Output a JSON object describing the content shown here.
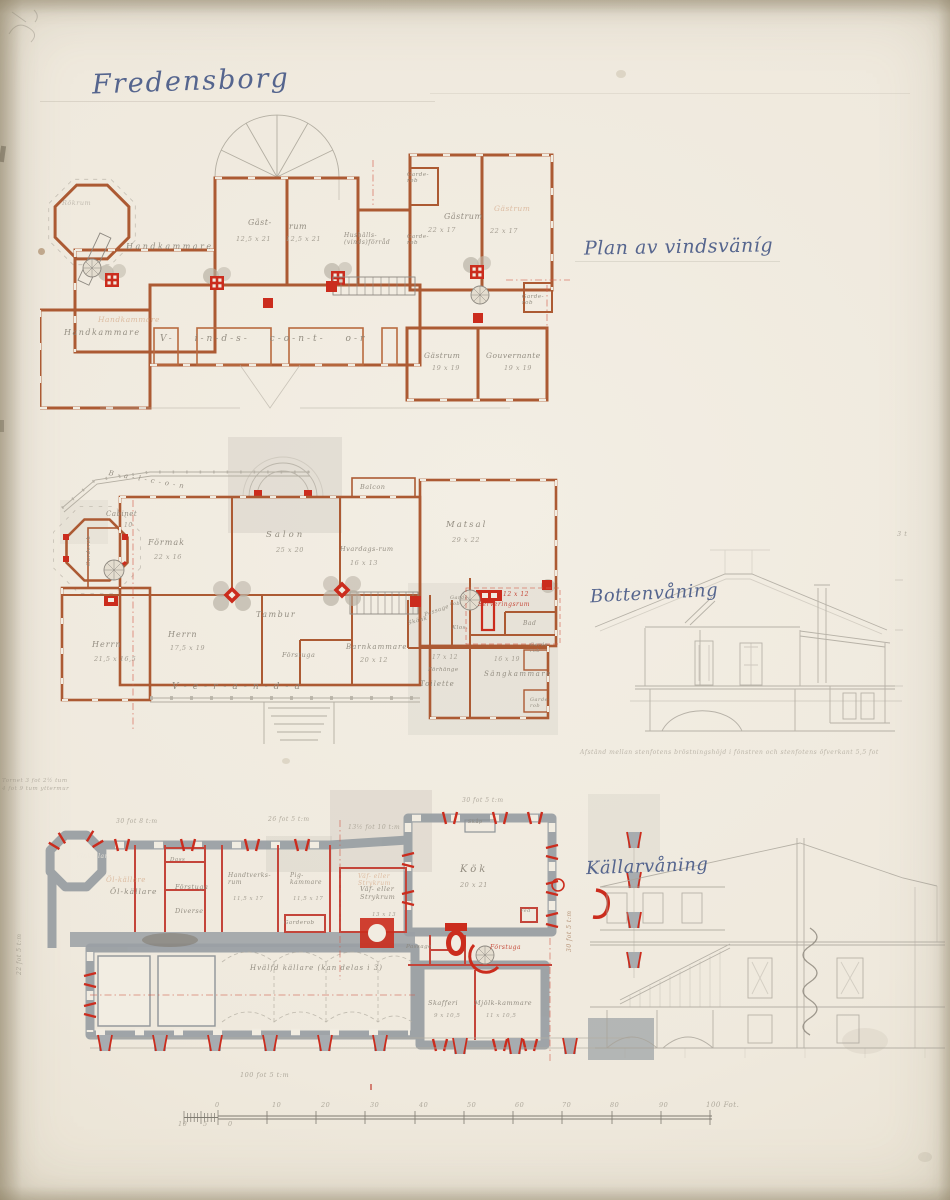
{
  "title": "Fredensborg",
  "floor_labels": {
    "attic": "Plan av vindsväníg",
    "ground": "Bottenvåning",
    "basement": "Källarvåning"
  },
  "notes": {
    "section_note": "Afstånd mellan stenfotens bröstningshöjd i fönstren och stenfotens öfverkant 5,5 fot",
    "margin_note": "Tornet 3 fot 2½ tum\n4 fot 9 tum yttermur",
    "roof_note": "3 t"
  },
  "attic": {
    "rooms": [
      {
        "label": "Rökrum"
      },
      {
        "label": "Handkammare"
      },
      {
        "label": "Gäst-",
        "dims": "12,5 x 21"
      },
      {
        "label": "rum",
        "dims": "12,5 x 21"
      },
      {
        "label": "Hushålls-\n(vinds)förråd"
      },
      {
        "label": "Gästrum",
        "dims": "22 x 17"
      },
      {
        "label": "Gästrum",
        "dims": "22 x 17"
      },
      {
        "label": "Garde-\nrob"
      },
      {
        "label": "Garde-\nrob"
      },
      {
        "label": "Garde-\nrob"
      },
      {
        "label": "Handkammare"
      },
      {
        "label": "V- i-n-d-s-  c-o-n-t- o-r"
      },
      {
        "label": "Gästrum",
        "dims": "19 x 19"
      },
      {
        "label": "Gouvernante",
        "dims": "19 x 19"
      }
    ]
  },
  "ground": {
    "rooms": [
      {
        "label": "B-a-l-c-o-n"
      },
      {
        "label": "Cabinet",
        "dims": "10"
      },
      {
        "label": "Garderob"
      },
      {
        "label": "Förmak",
        "dims": "22 x 16"
      },
      {
        "label": "Salon",
        "dims": "25 x 20"
      },
      {
        "label": "Balcon"
      },
      {
        "label": "Hvardags-rum",
        "dims": "16 x 13"
      },
      {
        "label": "Matsal",
        "dims": "29 x 22"
      },
      {
        "label": "Herrn",
        "dims": "21,5 x 16,5"
      },
      {
        "label": "Herrn",
        "dims": "17,5 x 19"
      },
      {
        "label": "Tambur"
      },
      {
        "label": "Förstuga"
      },
      {
        "label": "Barnkammare",
        "dims": "20 x 12"
      },
      {
        "label": "V-e-r-a-n-d-a"
      },
      {
        "label": "Serveringsrum",
        "dims": "12 x 12"
      },
      {
        "label": "Bad"
      },
      {
        "label": "Skänk"
      },
      {
        "label": "Passage"
      },
      {
        "label": "Klos."
      },
      {
        "label": "Garde-\nrob"
      },
      {
        "label": "Toilette",
        "dims": "17 x 12"
      },
      {
        "label": "Förhänge"
      },
      {
        "label": "Sängkammare",
        "dims": "16 x 19"
      },
      {
        "label": "Garde-\nrob"
      },
      {
        "label": "Garde-\nrob"
      }
    ]
  },
  "basement": {
    "rooms": [
      {
        "label": "Vinkällare"
      },
      {
        "label": "Öl-källare"
      },
      {
        "label": "Dass"
      },
      {
        "label": "Förstuga"
      },
      {
        "label": "Diverse"
      },
      {
        "label": "Handtverks-\nrum",
        "dims": "11,5 x 17"
      },
      {
        "label": "Pig-\nkammare",
        "dims": "11,5 x 17"
      },
      {
        "label": "Garderob"
      },
      {
        "label": "Kök",
        "dims": "20 x 21"
      },
      {
        "label": "Skåp"
      },
      {
        "label": "Väf- eller\nStrykrum",
        "dims": "13 x 13"
      },
      {
        "label": "Passage"
      },
      {
        "label": "Förstuga"
      },
      {
        "label": "Ved"
      },
      {
        "label": "Hvälfd källare (kan delas i 3)"
      },
      {
        "label": "Skafferi",
        "dims": "9 x 10,5"
      },
      {
        "label": "Mjölk-kammare",
        "dims": "11 x 10,5"
      }
    ],
    "dim_labels": [
      "30 fot 8 t:m",
      "26 fot 5 t:m",
      "13½ fot 10 t:m",
      "30 fot 5 t:m",
      "100 fot 5 t:m",
      "30 fot 5 t:m",
      "22 fot 5 t:m"
    ]
  },
  "scale_bar": {
    "upper_ticks": [
      "0",
      "10",
      "20",
      "30",
      "40",
      "50",
      "60",
      "70",
      "80",
      "90"
    ],
    "end_label": "100 Fot.",
    "lower_ticks": [
      "10",
      "5",
      "0"
    ]
  },
  "colors": {
    "wall_sienna": "#ac5a33",
    "accent_red": "#cb2c1d",
    "wall_gray": "#9aa0a4",
    "pencil": "#a9a49a",
    "ink_blue": "#4d5e8a",
    "paper": "#f1ece1"
  }
}
